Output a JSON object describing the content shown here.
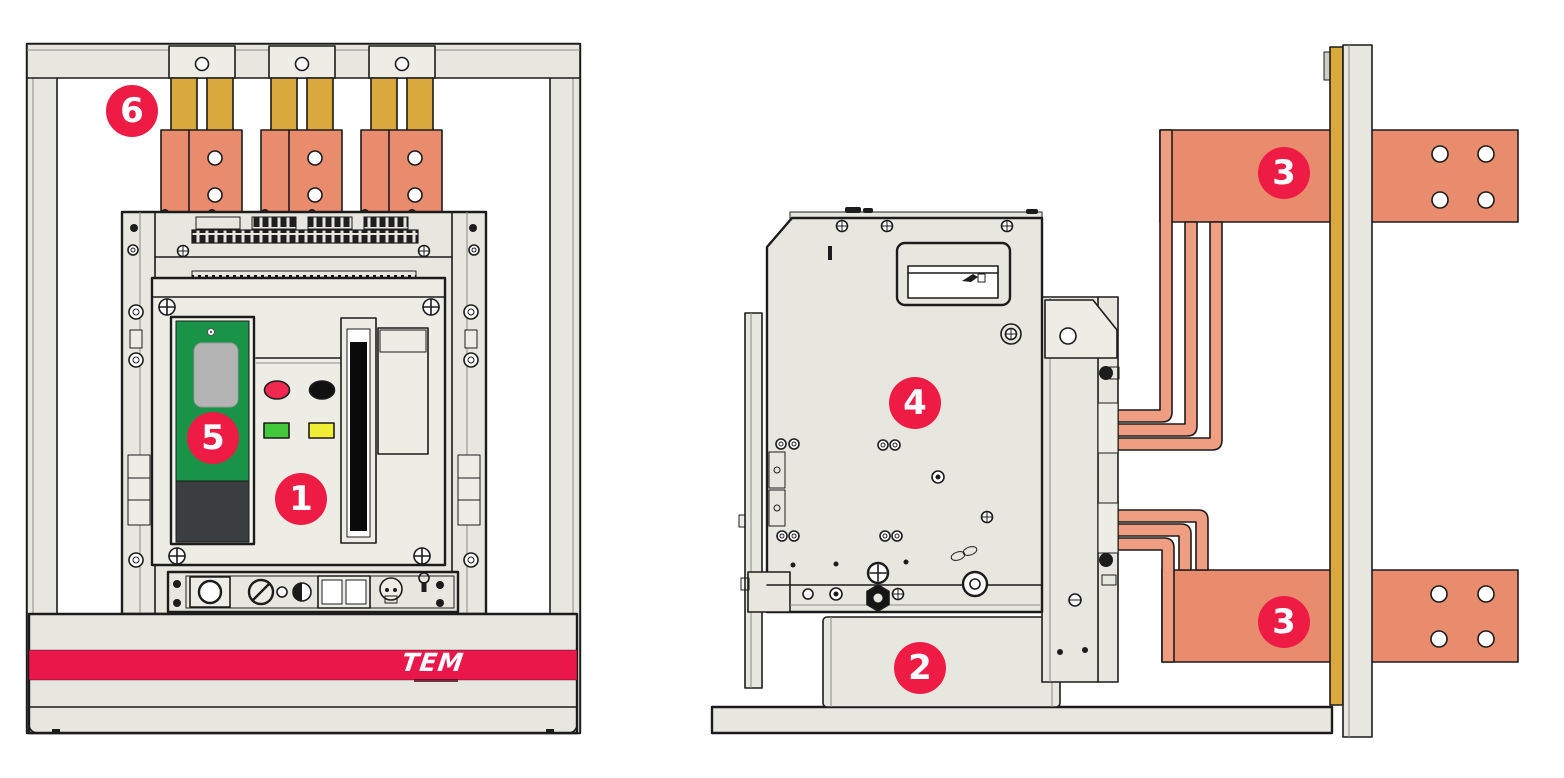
{
  "figure": {
    "kind": "air-circuit-breaker installation diagram",
    "views": [
      "front-view",
      "side-view"
    ]
  },
  "callouts": [
    {
      "part": "breaker-front-panel",
      "label": "1"
    },
    {
      "part": "mounting-base",
      "label": "2"
    },
    {
      "part": "upper-busbar",
      "label": "3"
    },
    {
      "part": "lower-busbar",
      "label": "3"
    },
    {
      "part": "breaker-side-body",
      "label": "4"
    },
    {
      "part": "trip-unit",
      "label": "5"
    },
    {
      "part": "top-connection",
      "label": "6"
    }
  ],
  "brand": {
    "logo_text": "TEM"
  },
  "colors": {
    "callout_red": "#ee1b45",
    "stripe_red": "#e9174a",
    "busbar_salmon": "#e98c6e",
    "link_salmon": "#f09e82",
    "gold": "#d9a93e",
    "frame_beige": "#e8e7df",
    "panel_beige": "#edece5",
    "trip_green": "#189347",
    "trip_dark": "#3b3e41",
    "display_gray": "#b4b4b4",
    "button_red": "#ef2950",
    "button_black": "#111111",
    "indicator_green": "#43c83b",
    "indicator_yellow": "#f2ee36",
    "line_dark": "#1c1c1c"
  }
}
